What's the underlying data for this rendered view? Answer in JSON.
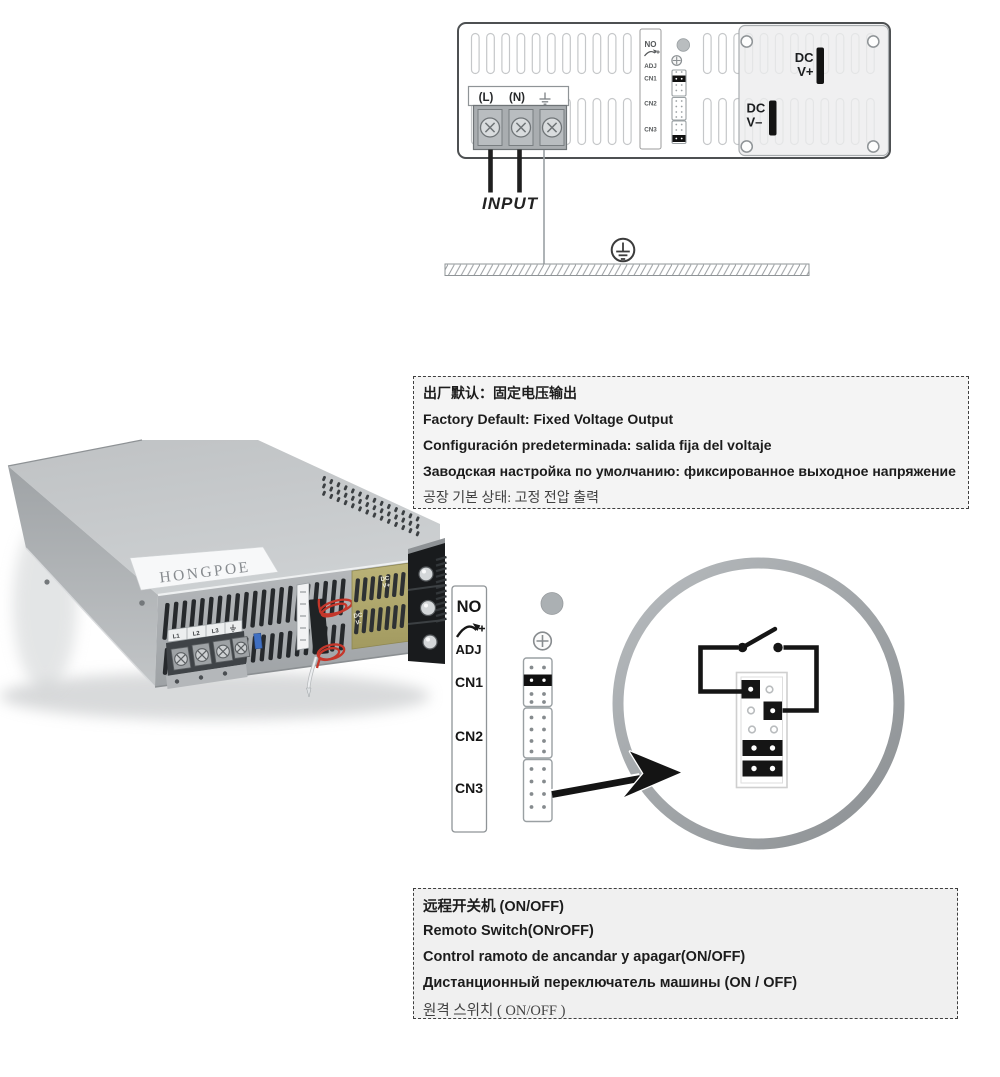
{
  "colors": {
    "diagram_ink": "#1a1a1a",
    "panel_fill": "#f0f0f1",
    "ring_gray": "#a6abae",
    "wire_red": "#c5372b",
    "pcb_gold": "#b2aa6d",
    "note_bg": "#f0f0f0"
  },
  "rear_panel_diagram": {
    "terminal_labels": {
      "live": "(L)",
      "neutral": "(N)"
    },
    "connector_strip_labels": [
      "NO",
      "ADJ",
      "CN1",
      "CN2",
      "CN3"
    ],
    "dc_positive_label": [
      "DC",
      "V+"
    ],
    "dc_negative_label": [
      "DC",
      "V–"
    ],
    "input_label": "INPUT"
  },
  "factory_default_note": {
    "lines": [
      "出厂默认：固定电压输出",
      "Factory Default: Fixed Voltage Output",
      "Configuración predeterminada: salida fija del voltaje",
      "Заводская настройка по умолчанию: фиксированное выходное напряжение",
      "공장 기본 상태: 고정 전압 출력"
    ]
  },
  "psu_photo": {
    "brand": "HONGPOE",
    "terminal_cell_labels": [
      "L1",
      "L2",
      "L3"
    ],
    "pcb_dc_positive": [
      "DC",
      "V+"
    ],
    "pcb_dc_negative": [
      "DC",
      "V-"
    ]
  },
  "remote_switch_diagram": {
    "connector_strip_labels": [
      "NO",
      "ADJ",
      "CN1",
      "CN2",
      "CN3"
    ]
  },
  "remote_switch_note": {
    "lines": [
      "远程开关机  (ON/OFF)",
      "Remoto Switch(ONrOFF)",
      "Control ramoto de ancandar y apagar(ON/OFF)",
      "Дистанционный переключатель машины (ON / OFF)",
      "원격 스위치 ( ON/OFF )"
    ]
  }
}
